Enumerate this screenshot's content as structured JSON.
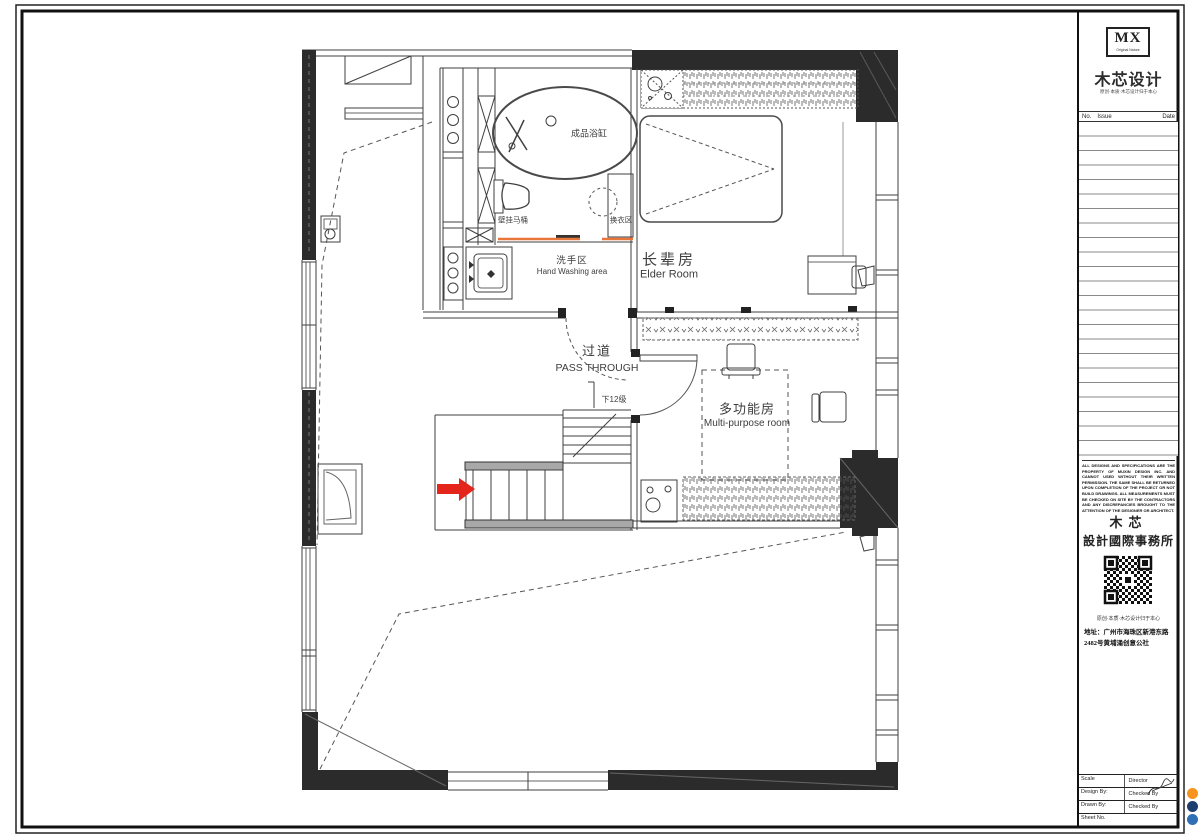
{
  "plan": {
    "fixtures": {
      "bathtub": "成品浴缸",
      "toilet": "壁挂马桶",
      "changing_area": "换衣区",
      "stairs_note": "下12级"
    },
    "rooms": {
      "wash": {
        "zh": "洗手区",
        "en": "Hand Washing area"
      },
      "elder": {
        "zh": "长辈房",
        "en": "Elder Room"
      },
      "pass": {
        "zh": "过道",
        "en": "PASS THROUGH"
      },
      "multi": {
        "zh": "多功能房",
        "en": "Multi-purpose room"
      }
    }
  },
  "title_block": {
    "logo_text": "MX",
    "logo_subtitle": "Original Nature",
    "brand_title": "木芯设计",
    "brand_tagline": "原创·本质·木芯设计归于本心",
    "table": {
      "no": "No.",
      "issue": "Issue",
      "date": "Date"
    },
    "disclaimer": "ALL DESIGNS AND SPECIFICATIONS ARE THE PROPERTY OF MUXIN DESIGN INC. AND CANNOT USED WITHOUT THEIR WRITTEN PERMISSION. THE SAME SHALL BE RETURNED UPON COMPLETION OF THE PROJECT OR NOT BUILD DRAWINGS. ALL MEASUREMENTS MUST BE CHECKED ON SITE BY THE CONTRACTORS AND ANY DISCREPANCIES BROUGHT TO THE ATTENTION OF THE DESIGNER OR ARCHITECT.",
    "firm_name_top": "木芯",
    "firm_name_bottom": "設計國際事務所",
    "motto": "原创·本质·木芯设计归于本心",
    "address_line1": "地址：广州市海珠区新港东路",
    "address_line2": "2482号黄埔涌创意公社",
    "fields": {
      "scale": "Scale",
      "director": "Director",
      "design_by": "Design By:",
      "checked_by": "Checked By",
      "drawn_by": "Drawn By:",
      "checked_by2": "Checked By",
      "sheet_no": "Sheet No."
    }
  },
  "watermark": {
    "text": "利用 pdfFactory Pro 测试版本创建的PDF文档",
    "link": "pdffactorychina.cn"
  },
  "colors": {
    "arrow_red": "#e4251c",
    "floor_line_orange": "#e8763a",
    "watermark_text": "#e00000",
    "watermark_link": "#2121cc",
    "dot_orange": "#f7941d",
    "dot_navy": "#1d3e6f",
    "dot_blue": "#2f6fb5"
  }
}
